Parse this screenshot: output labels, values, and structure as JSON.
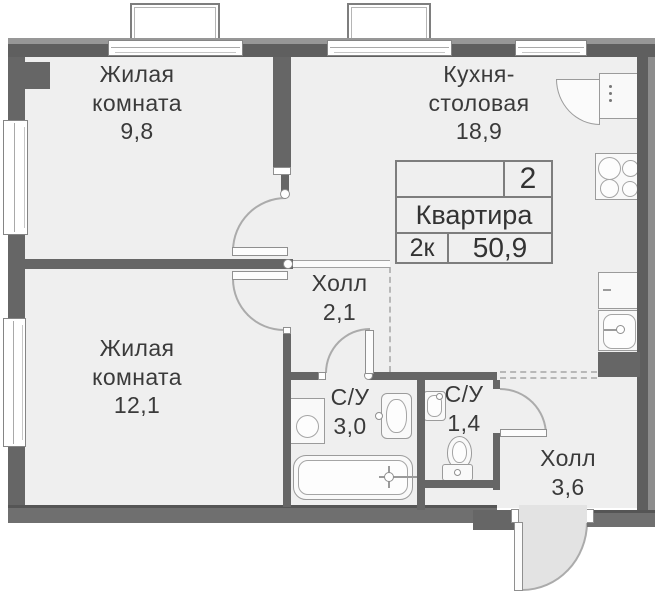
{
  "rooms": {
    "living1": {
      "label": "Жилая комната",
      "area": "9,8"
    },
    "kitchen": {
      "label": "Кухня-столовая",
      "area": "18,9"
    },
    "hall": {
      "label": "Холл",
      "area": "2,1"
    },
    "living2": {
      "label": "Жилая комната",
      "area": "12,1"
    },
    "bath1": {
      "label": "С/У",
      "area": "3,0"
    },
    "bath2": {
      "label": "С/У",
      "area": "1,4"
    },
    "entry_hall": {
      "label": "Холл",
      "area": "3,6"
    }
  },
  "info_card": {
    "rooms_count": "2",
    "title": "Квартира",
    "layout_code": "2к",
    "total_area": "50,9"
  },
  "colors": {
    "wall": "#666666",
    "floor": "#efefef",
    "fixture_outline": "#9b9b9b",
    "dashed_line": "#b8b8b8",
    "text": "#3a3a3a",
    "entry_door_fill": "#e3e3e3"
  },
  "icons": {
    "fixtures": [
      "bathtub-icon",
      "washing-machine-icon",
      "sink-icon",
      "toilet-icon",
      "fridge-icon",
      "stove-icon",
      "kitchen-sink-icon",
      "door-swing-arc"
    ]
  }
}
